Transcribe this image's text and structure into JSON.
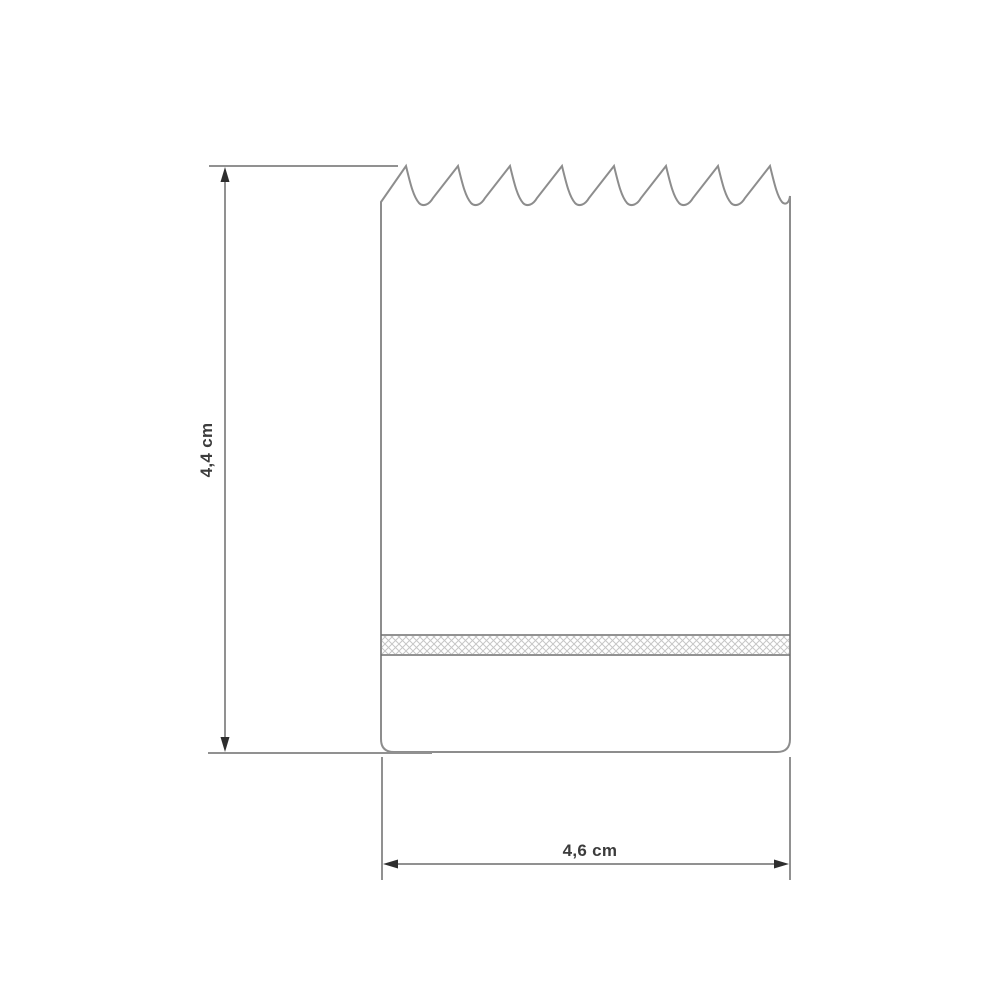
{
  "page": {
    "background": "#ffffff"
  },
  "drawing": {
    "kind": "technical-line-drawing",
    "subject": "hole saw cutter side view with serrated teeth and knurled band",
    "teeth_count": 8,
    "dimensions": {
      "height": {
        "label": "4,4 cm",
        "value_cm": 4.4,
        "orientation": "vertical"
      },
      "width": {
        "label": "4,6 cm",
        "value_cm": 4.6,
        "orientation": "horizontal"
      }
    },
    "colors": {
      "outline": "#8d8d8d",
      "dimension_line": "#919191",
      "band_border": "#6f6f6f",
      "hatch": "#c6c6c6",
      "arrowhead": "#2e2e2e",
      "label_text": "#3c3c3c",
      "background": "#ffffff"
    }
  }
}
